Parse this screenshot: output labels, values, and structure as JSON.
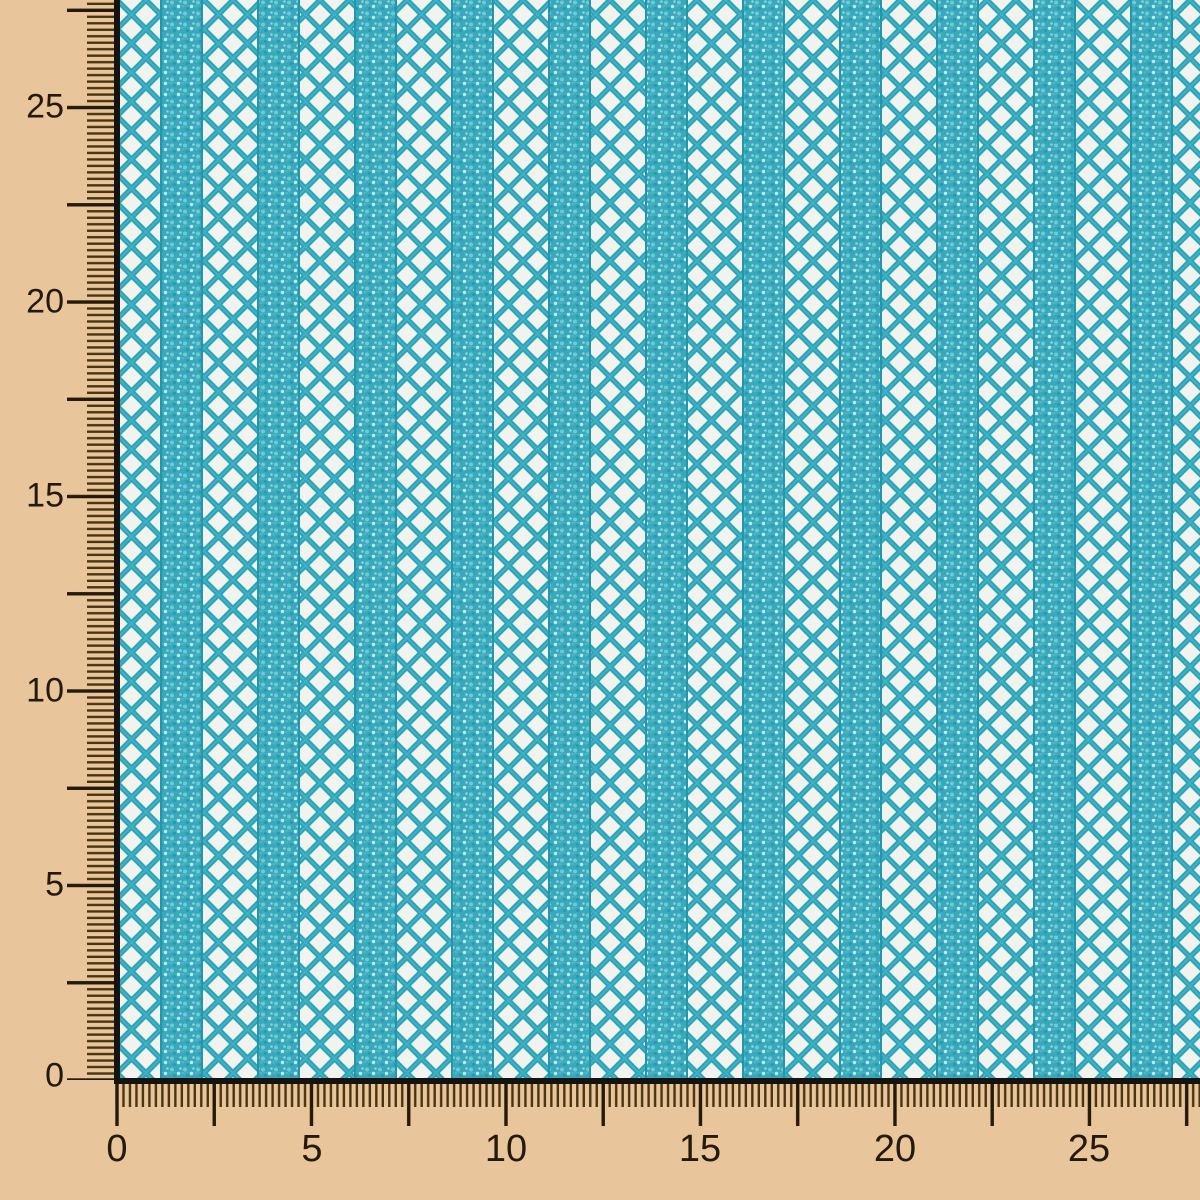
{
  "photo": {
    "description": "Turquoise teal crochet mesh lace fabric swatch photographed on a tan measuring board with rulers along the left and bottom edges",
    "fabric": {
      "pattern": "alternating solid knit stripes and open diamond-lattice crochet columns",
      "thread_color": "#2ba3b8",
      "stripe_color": "#37a9bd",
      "hole_color": "#f1f3ee"
    },
    "board": {
      "background_color": "#e8c59b",
      "minor_tick_color": "#4a3512",
      "major_tick_color": "#241a07",
      "edge_line_color": "#151310",
      "label_color": "#241a0b"
    }
  },
  "left_ruler": {
    "labels": [
      "0",
      "5",
      "10",
      "15",
      "20",
      "25"
    ]
  },
  "bottom_ruler": {
    "labels": [
      "0",
      "5",
      "10",
      "15",
      "20",
      "25"
    ]
  }
}
